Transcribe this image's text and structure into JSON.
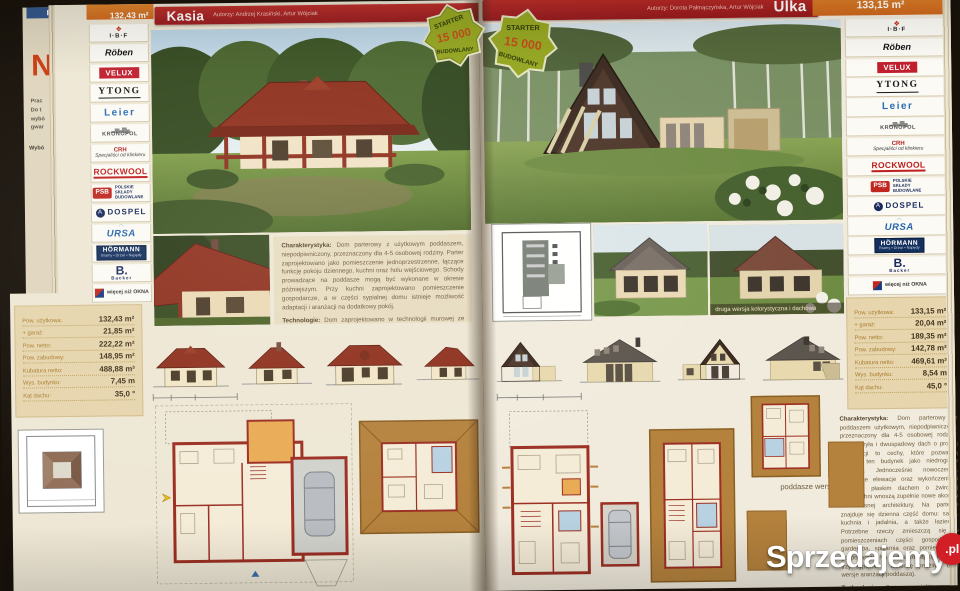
{
  "palette": {
    "title_bar_red": "#a81f22",
    "area_orange": "#d9731f",
    "badge_green": "#94a51e",
    "spec_bg": "#e6d5ad",
    "page_cream": "#eee7d5",
    "roof_red": "#8e2f1d",
    "watermark_red": "#d21f26"
  },
  "watermark": {
    "text": "Sprzedajemy",
    "tld": ".pl"
  },
  "badge": {
    "top": "STARTER",
    "value": "15 000",
    "bottom": "BUDOWLANY"
  },
  "prev_page": {
    "tab": "Pr",
    "initial": "N",
    "lines": [
      "Prac",
      "Do t",
      "wybó",
      "gwar"
    ],
    "link": "Wybó"
  },
  "sponsors": [
    {
      "name": "I·B·F",
      "mark": "❖",
      "sub": ""
    },
    {
      "name": "Röben",
      "sub": ""
    },
    {
      "name": "VELUX",
      "sub": ""
    },
    {
      "name": "YTONG",
      "sub": ""
    },
    {
      "name": "Leier",
      "sub": ""
    },
    {
      "name": "KRONOPOL",
      "mark": "▂▅▃▆▄",
      "sub": ""
    },
    {
      "name": "CRH",
      "sub": "Specjaliści od klinkieru"
    },
    {
      "name": "ROCKWOOL",
      "sub": ""
    },
    {
      "name": "PSB",
      "sub": "POLSKIE SKŁADY BUDOWLANE"
    },
    {
      "name": "DOSPEL",
      "mark": "A",
      "sub": ""
    },
    {
      "name": "URSA",
      "mark": "◠",
      "sub": ""
    },
    {
      "name": "HÖRMANN",
      "sub": "Bramy • Drzwi • Napędy"
    },
    {
      "name": "B.",
      "sub": "Backer"
    },
    {
      "name": "MS",
      "sub": "więcej niż OKNA"
    }
  ],
  "left_page": {
    "area": "132,43 m²",
    "title": "Kasia",
    "authors": "Autorzy: Andrzej Krasiński, Artur Wójciak",
    "specs": [
      {
        "label": "Pow. użytkowa:",
        "value": "132,43 m²"
      },
      {
        "label": "+ garaż:",
        "value": "21,85 m²"
      },
      {
        "label": "Pow. netto:",
        "value": "222,22 m²"
      },
      {
        "label": "Pow. zabudowy:",
        "value": "148,95 m²"
      },
      {
        "label": "Kubatura netto:",
        "value": "488,88 m³"
      },
      {
        "label": "Wys. budynku:",
        "value": "7,45 m"
      },
      {
        "label": "Kąt dachu:",
        "value": "35,0 °"
      }
    ],
    "charakterystyka_label": "Charakterystyka:",
    "charakterystyka": "Dom parterowy z użytkowym poddaszem, niepodpiwniczony, przeznaczony dla 4-5 osobowej rodziny. Parter zaprojektowano jako pomieszczenie jednoprzestrzenne, łączące funkcję pokoju dziennego, kuchni oraz holu wejściowego. Schody prowadzące na poddasze mogą być wykonane w okresie późniejszym. Przy kuchni zaprojektowano pomieszczenie gospodarcze, a w części sypialnej domu istnieje możliwość adaptacji i aranżacji na dodatkowy pokój.",
    "technologie_label": "Technologie:",
    "technologie": "Dom zaprojektowano w technologii murowej ze stropem gęstożebrowym, pokryty dachówką cementową lub blachodachówką. Elewację wykonano z tynku strukturalnego i cegły klinkierowej. Więźbę zaprojektowano jako konstrukcję drewnianą. Stolarka okienna drewniana lub PCV."
  },
  "right_page": {
    "area": "133,15 m²",
    "title": "Ulka",
    "authors": "Autorzy: Dorota Pałmączyńska, Artur Wójciak",
    "specs": [
      {
        "label": "Pow. użytkowa:",
        "value": "133,15 m²"
      },
      {
        "label": "+ garaż:",
        "value": "20,04 m²"
      },
      {
        "label": "Pow. netto:",
        "value": "189,35 m²"
      },
      {
        "label": "Pow. zabudowy:",
        "value": "142,78 m²"
      },
      {
        "label": "Kubatura netto:",
        "value": "469,61 m³"
      },
      {
        "label": "Wys. budynku:",
        "value": "8,54 m"
      },
      {
        "label": "Kąt dachu:",
        "value": "45,0 °"
      }
    ],
    "photo_caption": "druga wersja kolorystyczna i dachowa",
    "attic_caption": "poddasze wersja II",
    "charakterystyka_label": "Charakterystyka:",
    "charakterystyka": "Dom parterowy z poddaszem użytkowym, niepodpiwniczony, przeznaczony dla 4-5 osobowej rodziny. Prosta bryła i dwuspadowy dach o prostej konstrukcji to cechy, które pozwalają określić ten budynek jako niedrogi w realizacji. Jednocześnie nowoczesne, oryginalne elewacje oraz wykończenia i garaż z płaskim dachem o żwirowej nawierzchni wnoszą zupełnie nowe akcenty nowoczesnej architektury. Na parterze znajduje się dzienna część domu: salon, kuchnia i jadalnia, a także łazienka. Potrzebne rzeczy zmieszczą się w pomieszczeniach części gospodarczej: garderoba, spiżarnia oraz pomieszczenie gospodarcze. Na poddaszu zaprojektowano trzy sypialnie i łazienkę (możliwe dwie wersje aranżacji poddasza).",
    "technologie_label": "Technologie:",
    "technologie": "Dom zaprojektowano w technologii murowej ze stropem gęstożebrowym."
  }
}
